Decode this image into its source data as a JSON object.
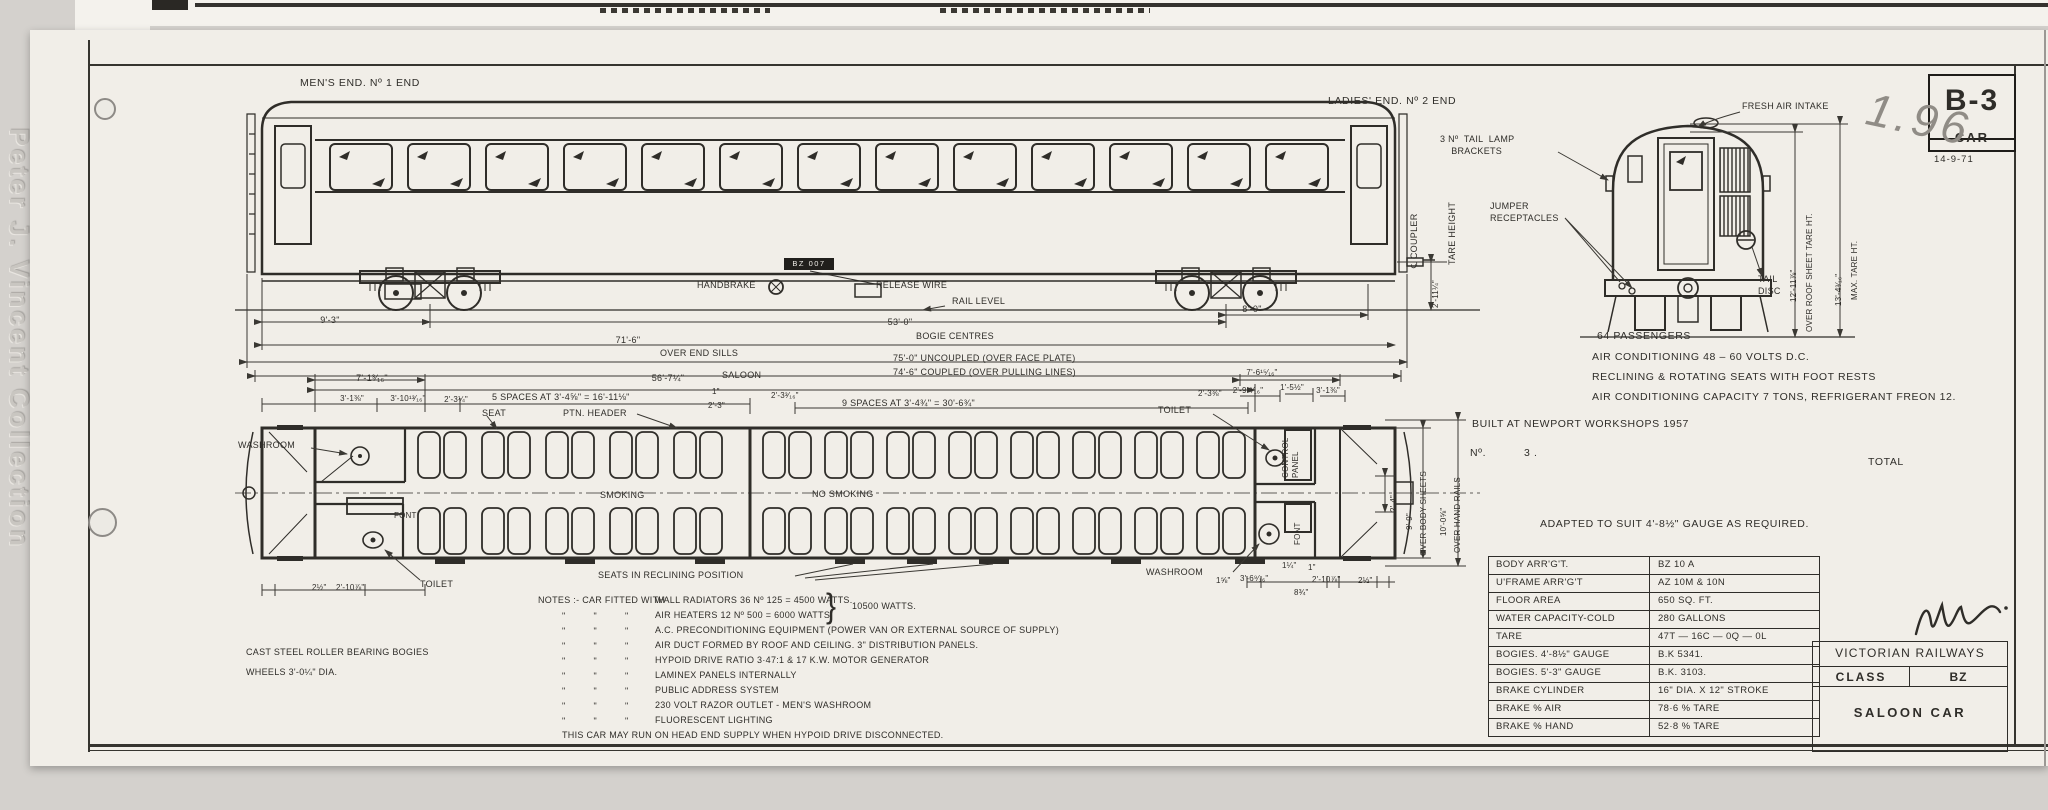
{
  "colors": {
    "ink": "#2f2d29",
    "paper": "#f1eee8",
    "pencil": "#908c86"
  },
  "watermark": "Peter J. Vincent Collection",
  "corner_box": {
    "number": "B-3",
    "car": "CAR",
    "date": "14-9-71"
  },
  "pencil_note": "1.96",
  "side": {
    "mens_end": "MEN'S END.  Nº 1 END",
    "ladies_end": "LADIES' END. Nº 2 END",
    "handbrake": "HANDBRAKE",
    "release_wire": "RELEASE WIRE",
    "rail_level": "RAIL LEVEL",
    "number_plate": "BZ 007",
    "coupler": "℄ COUPLER",
    "tare_height": "TARE HEIGHT",
    "dim_coupler_height": "2'-11¼\"",
    "dim_bogie_wheelbase": "9'-3\"",
    "dim_bogie_centres": "53'-0\"",
    "bogie_centres_label": "BOGIE CENTRES",
    "dim_bogie_to_end": "8'-0\"",
    "dim_over_end_sills": "71'-6\"",
    "over_end_sills_label": "OVER  END  SILLS",
    "dim_uncoupled": "75'-0\" UNCOUPLED  (OVER FACE PLATE)",
    "dim_coupled": "74'-6\" COUPLED  (OVER PULLING LINES)"
  },
  "plan": {
    "dim_saloon": "56'-7¼\"",
    "saloon_label": "SALOON",
    "dim_end_bay": "7'-1³⁄₁₆\"",
    "dim_a": "3'-1⅜\"",
    "dim_b": "3'-10¹³⁄₁₆\"",
    "dim_c": "2'-3¼\"",
    "spaces_left": "5  SPACES AT  3'-4⅝\"  =  16'-11⅛\"",
    "seat_label": "SEAT",
    "ptn_header_label": "PTN.  HEADER",
    "dim_d": "1\"",
    "dim_e": "2'-3\"",
    "dim_f": "2'-3³⁄₁₆\"",
    "spaces_right": "9  SPACES AT  3'-4¾\"  =  30'-6¾\"",
    "dim_g": "2'-3⅜\"",
    "dim_h": "7'-6¹⁵⁄₁₆\"",
    "dim_i": "2'-9¹³⁄₁₆\"",
    "dim_j": "1'-5½\"",
    "dim_k": "3'-1⅜\"",
    "washroom_left": "WASHROOM",
    "font_left": "FONT",
    "toilet_left": "TOILET",
    "smoking": "SMOKING",
    "no_smoking": "NO  SMOKING",
    "reclining_label": "SEATS  IN  RECLINING  POSITION",
    "toilet_right": "TOILET",
    "control_panel": "CONTROL\nPANEL",
    "font_right": "FONT",
    "washroom_right": "WASHROOM",
    "dim_over_body": "9'-9\"",
    "over_body_label": "OVER BODY SHEETS",
    "dim_over_rails": "10'-0⅝\"",
    "over_rails_label": "OVER HAND RAILS",
    "dim_door": "2'-4\"",
    "dim_bl1": "2½\"",
    "dim_bl2": "2'-10⅞\"",
    "dim_br1": "1⅝\"",
    "dim_br2": "3'-6⁹⁄₁₆\"",
    "dim_br3": "8¾\"",
    "dim_br4": "2'-10⅞\"",
    "dim_br5": "2½\"",
    "dim_br6": "1¼\"",
    "dim_br7": "1\""
  },
  "end_view": {
    "fresh_air": "FRESH AIR INTAKE",
    "tail_lamp": "3 Nº  TAIL  LAMP\n    BRACKETS",
    "jumper": "JUMPER\nRECEPTACLES",
    "tail_disc": "TAIL\nDISC",
    "dim_roof": "12'-11⅞\"",
    "roof_label": "OVER  ROOF  SHEET  TARE  HT.",
    "dim_max": "13'-4³⁄₁₆\"",
    "max_label": "MAX.  TARE  HT."
  },
  "info": {
    "passengers": "64 PASSENGERS",
    "air_conditioning": "AIR CONDITIONING   48 – 60  VOLTS  D.C.",
    "seats": "RECLINING  &  ROTATING  SEATS  WITH  FOOT  RESTS",
    "capacity": "AIR CONDITIONING  CAPACITY   7 TONS,  REFRIGERANT FREON 12.",
    "built": "BUILT  AT  NEWPORT  WORKSHOPS      1957",
    "number_label": "Nº.",
    "number_value": "3 .",
    "total": "TOTAL",
    "adapted": "ADAPTED  TO  SUIT  4'-8½\"  GAUGE  AS  REQUIRED."
  },
  "notes": {
    "intro": "NOTES :- CAR  FITTED  WITH",
    "ditto": "\"          \"          \"",
    "items": [
      "WALL RADIATORS   36 Nº 125 = 4500 WATTS.",
      "AIR HEATERS         12 Nº 500 = 6000 WATTS.",
      "A.C.  PRECONDITIONING  EQUIPMENT (POWER VAN OR EXTERNAL  SOURCE  OF SUPPLY)",
      "AIR DUCT  FORMED  BY  ROOF AND CEILING. 3\" DISTRIBUTION  PANELS.",
      "HYPOID  DRIVE  RATIO 3·47:1 &  17  K.W.  MOTOR  GENERATOR",
      "LAMINEX  PANELS  INTERNALLY",
      "PUBLIC  ADDRESS  SYSTEM",
      "230 VOLT  RAZOR  OUTLET  - MEN'S  WASHROOM",
      "FLUORESCENT  LIGHTING"
    ],
    "radiators_total": "10500 WATTS.",
    "footer": "THIS  CAR  MAY  RUN  ON  HEAD  END  SUPPLY  WHEN  HYPOID  DRIVE  DISCONNECTED."
  },
  "bogie_note": {
    "line1": "CAST  STEEL  ROLLER  BEARING  BOGIES",
    "line2": "WHEELS  3'-0¼\"  DIA."
  },
  "spec_table": {
    "rows": [
      {
        "label": "BODY  ARR'G'T.",
        "value": "BZ 10 A"
      },
      {
        "label": "U'FRAME  ARR'G'T",
        "value": "AZ 10M & 10N"
      },
      {
        "label": "FLOOR  AREA",
        "value": "650  SQ. FT."
      },
      {
        "label": "WATER  CAPACITY-COLD",
        "value": "280 GALLONS"
      },
      {
        "label": "TARE",
        "value": "47T — 16C — 0Q — 0L"
      },
      {
        "label": "BOGIES.  4'-8½\"  GAUGE",
        "value": "B.K 5341."
      },
      {
        "label": "BOGIES.  5'-3\"  GAUGE",
        "value": "B.K. 3103."
      },
      {
        "label": "BRAKE  CYLINDER",
        "value": "16\" DIA. X 12\" STROKE"
      },
      {
        "label": "BRAKE % AIR",
        "value": "78·6 %  TARE"
      },
      {
        "label": "BRAKE % HAND",
        "value": "52·8 %  TARE"
      }
    ]
  },
  "title_block": {
    "railway": "VICTORIAN  RAILWAYS",
    "class_label": "CLASS",
    "class_value": "BZ",
    "car_type": "SALOON  CAR"
  }
}
